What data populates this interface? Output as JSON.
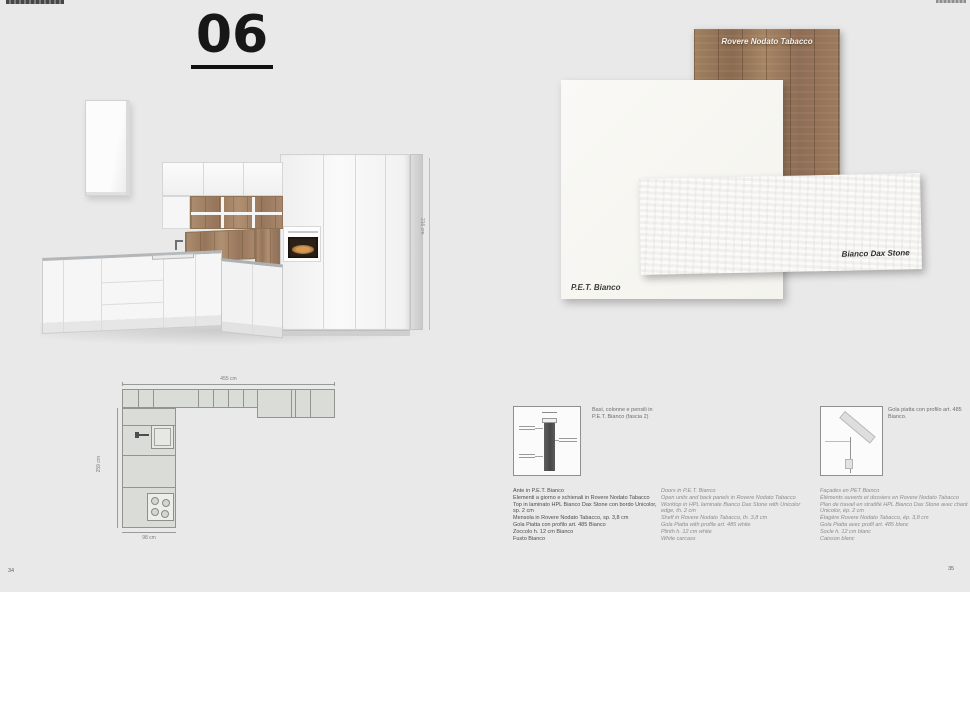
{
  "page": {
    "composition_number": "06",
    "page_left": "34",
    "page_right": "35"
  },
  "colors": {
    "page_background": "#e9e9e9",
    "wood": "#97765a",
    "plan_fill": "#dadcd8"
  },
  "swatches": {
    "wood": {
      "label": "Rovere Nodato Tabacco"
    },
    "pet": {
      "label": "P.E.T. Bianco"
    },
    "dax": {
      "label": "Bianco Dax Stone"
    }
  },
  "render": {
    "height_dim": "216 cm"
  },
  "floorplan": {
    "width_dim": "455 cm",
    "depth_dim": "259 cm",
    "return_dim": "98 cm"
  },
  "details": {
    "left_caption": "Basi, colonne e pensili in P.E.T. Bianco (fascia 2)",
    "right_caption": "Gola piatta con profilo art. 485 Bianco."
  },
  "specs": {
    "italian": [
      "Ante in P.E.T. Bianco",
      "Elementi a giorno e schienali in Rovere Nodato Tabacco",
      "Top in laminato HPL Bianco Dax Stone con bordo Unicolor, sp. 2 cm",
      "Mensola in Rovere Nodato Tabacco, sp. 3,8 cm",
      "Gola Piatta con profilo art. 485 Bianco",
      "Zoccolo h. 12 cm Bianco",
      "Fusto Bianco"
    ],
    "english": [
      "Doors in P.E.T. Bianco",
      "Open units and back panels in Rovere Nodato Tabacco",
      "Worktop in HPL laminate Bianco Dax Stone with Unicolor edge, th. 2 cm",
      "Shelf in Rovere Nodato Tabacco, th. 3,8 cm",
      "Gola Piatta with profile art. 485 white",
      "Plinth h. 12 cm white",
      "White carcass"
    ],
    "french": [
      "Façades en PET Bianco",
      "Éléments ouverts et dossiers en Rovere Nodato Tabacco",
      "Plan de travail en stratifié HPL Bianco Dax Stone avec chant Unicolor, ép. 2 cm",
      "Étagère Rovere Nodato Tabacco, ép. 3,8 cm",
      "Gola Piatta avec profil art. 485 blanc",
      "Socle h. 12 cm blanc",
      "Caisson blanc"
    ]
  }
}
